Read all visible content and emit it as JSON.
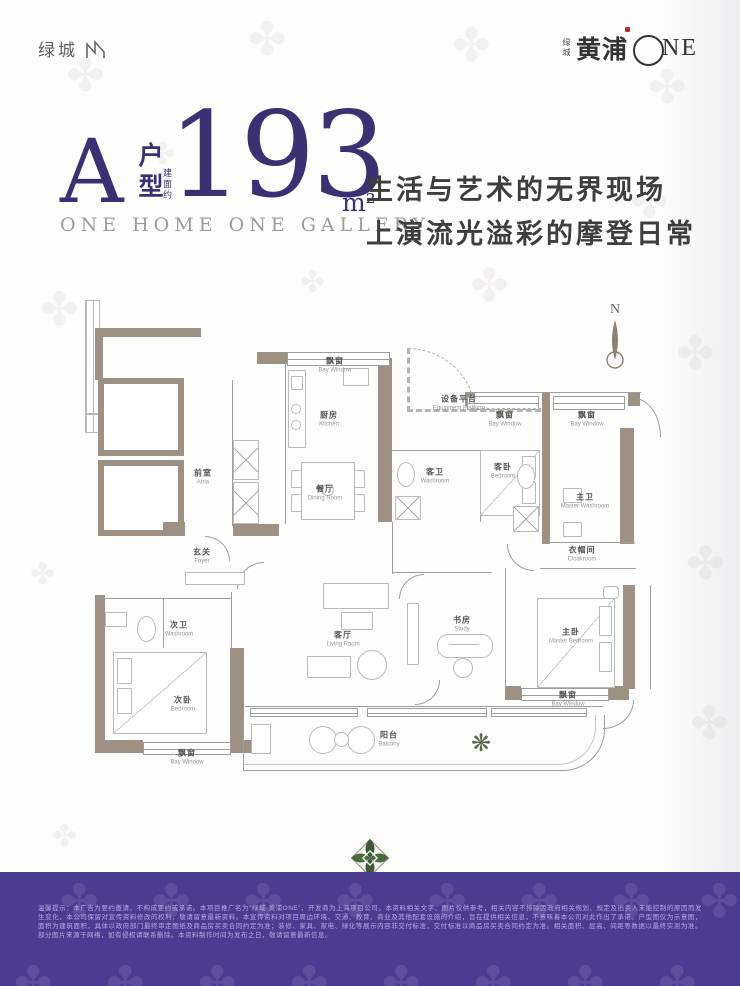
{
  "header": {
    "logo_left": "绿城",
    "logo_right": {
      "small": "绿城",
      "main": "黄浦",
      "suffix": "NE"
    }
  },
  "title": {
    "type_letter": "A",
    "type_label": "户型",
    "area_prefix": "建面约",
    "area_value": "193",
    "area_unit": "m²",
    "subtitle": "ONE HOME ONE GALLERY"
  },
  "tagline": {
    "line1": "生活与艺术的无界现场",
    "line2": "上演流光溢彩的摩登日常"
  },
  "floorplan": {
    "compass": "N",
    "rooms": {
      "atria": {
        "cn": "前室",
        "en": "Atria"
      },
      "foyer": {
        "cn": "玄关",
        "en": "Foyer"
      },
      "kitchen": {
        "cn": "厨房",
        "en": "Kitchen"
      },
      "kitchen_bay": {
        "cn": "飘窗",
        "en": "Bay Window"
      },
      "equipment": {
        "cn": "设备平台",
        "en": "Equipment Platform"
      },
      "guest_wash": {
        "cn": "客卫",
        "en": "Washroom"
      },
      "dining": {
        "cn": "餐厅",
        "en": "Dining Room"
      },
      "guest_bay": {
        "cn": "飘窗",
        "en": "Bay Window"
      },
      "guest_bed": {
        "cn": "客卧",
        "en": "Bedroom"
      },
      "master_bay_top": {
        "cn": "飘窗",
        "en": "Bay Window"
      },
      "master_wash": {
        "cn": "主卫",
        "en": "Master Washroom"
      },
      "cloakroom": {
        "cn": "衣帽间",
        "en": "Cloakroom"
      },
      "second_wash": {
        "cn": "次卫",
        "en": "Washroom"
      },
      "second_bed": {
        "cn": "次卧",
        "en": "Bedroom"
      },
      "second_bay": {
        "cn": "飘窗",
        "en": "Bay Window"
      },
      "living": {
        "cn": "客厅",
        "en": "Living Room"
      },
      "study": {
        "cn": "书房",
        "en": "Study"
      },
      "master_bed": {
        "cn": "主卧",
        "en": "Master Bedroom"
      },
      "master_bay_bottom": {
        "cn": "飘窗",
        "en": "Bay Window"
      },
      "balcony": {
        "cn": "阳台",
        "en": "Balcony"
      }
    }
  },
  "footer": {
    "disclaimer": "温馨提示：本广告为要约邀请，不构成要约或承诺。本项目推广名为“绿城·黄浦ONE”，开发商为上海项目公司。本资料相关文字、图片仅供参考，相关内容不排除因政府相关规划、规定及出卖人未能控制的原因而发生变化，本公司保留对宣传资料修改的权利，敬请留意最新资料。本宣传资料对项目周边环境、交通、教育、商业及其他配套设施的介绍，旨在提供相关信息，不意味着本公司对此作出了承诺。户型图仅为示意图，面积为建筑面积，具体以政府部门最终审定图纸及商品房买卖合同约定为准；装修、家具、家电、绿化等展示内容非交付标准，交付标准以商品房买卖合同约定为准。相关面积、层高、间距等数据以最终实测为准。部分图片来源于网络，如有侵权请联系删除。本资料制作时间为发布之日，敬请留意最新信息。"
  },
  "colors": {
    "accent_purple": "#3a3173",
    "band_purple": "#4b3c92",
    "wall_taupe": "#9c9183",
    "emblem_green": "#3c5a36"
  }
}
